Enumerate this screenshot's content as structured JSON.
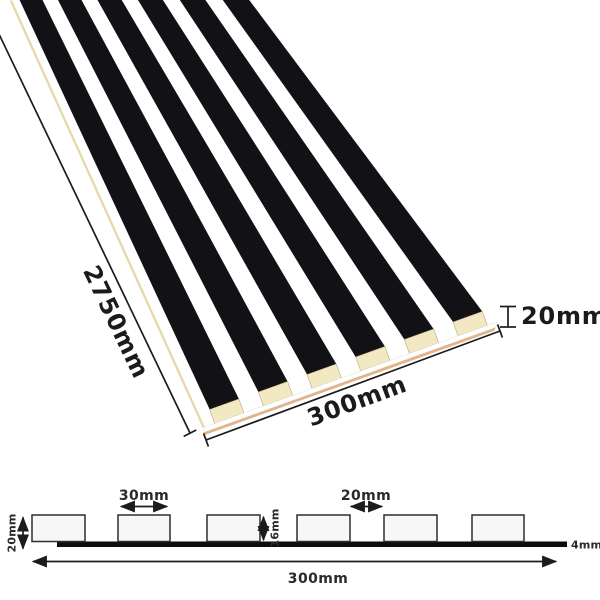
{
  "panel_view": {
    "length_label": "2750mm",
    "width_label": "300mm",
    "thickness_label": "20mm"
  },
  "cross_section": {
    "total_height_label": "20mm",
    "slat_width_label": "30mm",
    "gap_label": "20mm",
    "slat_height_label": "16mm",
    "backing_thickness_label": "4mm",
    "total_width_label": "300mm"
  },
  "colors": {
    "slat_black": "#111116",
    "wood_end_cream": "#f2e9c2",
    "wood_edge_tan": "#e2b48a",
    "section_slat_fill": "#f7f7f7",
    "backing_black": "#0d0d0d",
    "line_color": "#1c1c1c"
  }
}
